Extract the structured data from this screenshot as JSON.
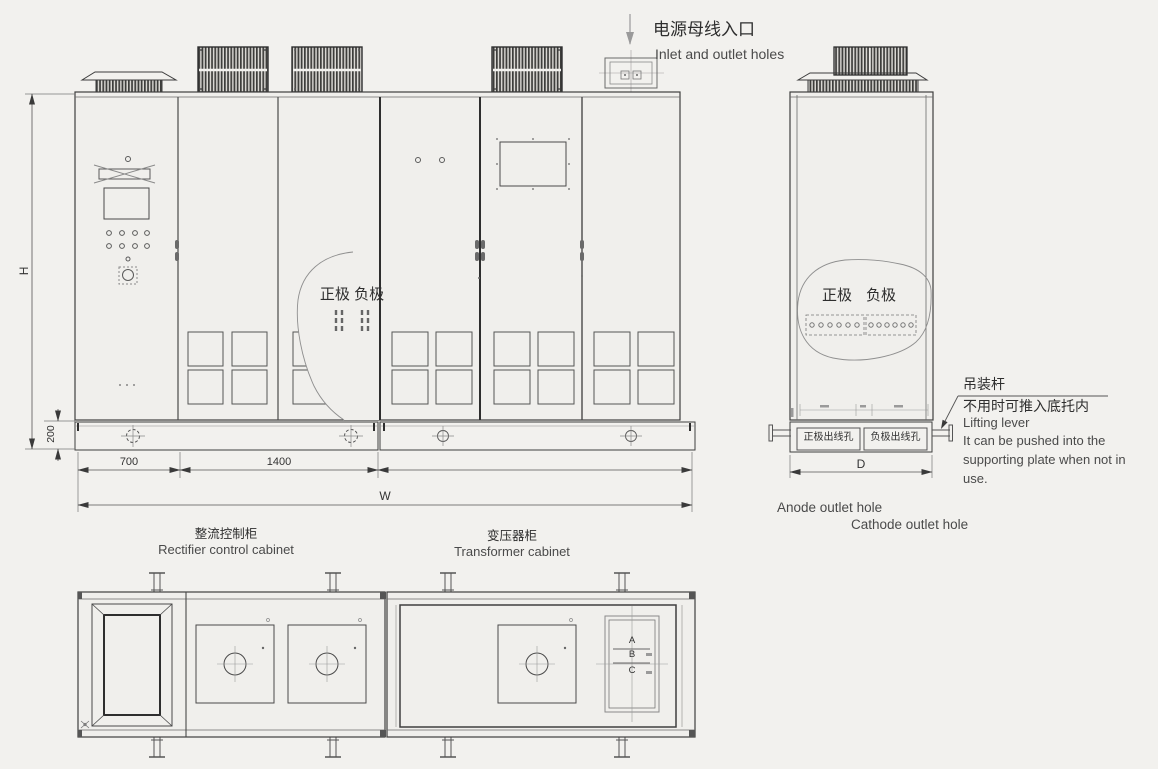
{
  "inlet": {
    "cn": "电源母线入口",
    "en": "Inlet and outlet holes"
  },
  "front": {
    "terminals": "正极 负极",
    "dim_h": "H",
    "dim_200": "200",
    "dim_700": "700",
    "dim_1400": "1400",
    "dim_w": "W",
    "rectifier_cn": "整流控制柜",
    "rectifier_en": "Rectifier control cabinet",
    "transformer_cn": "变压器柜",
    "transformer_en": "Transformer cabinet"
  },
  "side": {
    "anode": "正极",
    "cathode": "负极",
    "anode_hole": "正极出线孔",
    "cathode_hole": "负极出线孔",
    "dim_d": "D",
    "lifting_cn": "吊装杆",
    "lifting_note_cn": "不用时可推入底托内",
    "lifting_en": "Lifting lever",
    "lifting_note_en_1": "It can be pushed into the",
    "lifting_note_en_2": "supporting plate when not in",
    "lifting_note_en_3": "use.",
    "anode_hole_en": "Anode outlet hole",
    "cathode_hole_en": "Cathode outlet hole"
  },
  "plan": {
    "label_a": "A",
    "label_b": "B",
    "label_c": "C"
  },
  "colors": {
    "background": "#f2f1ee",
    "line": "#4a4a4a",
    "line_dark": "#2e2e2e",
    "fan_fill": "#3d3d3b",
    "text": "#3a3a3a"
  }
}
